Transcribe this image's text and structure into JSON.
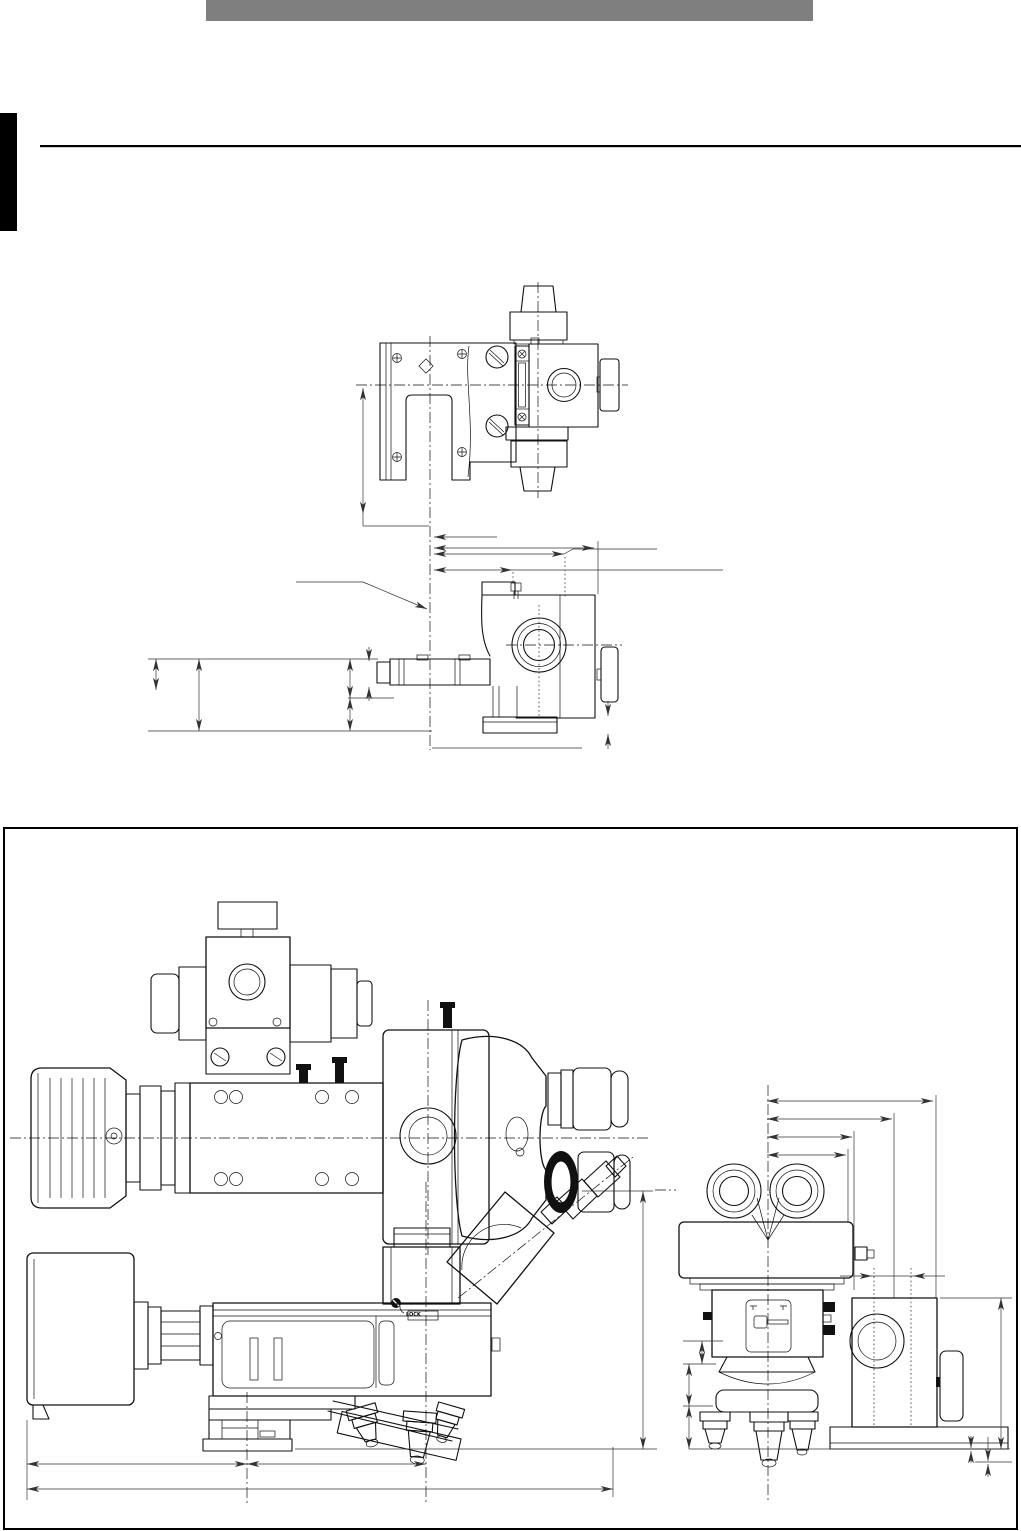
{
  "page": {
    "background": "#ffffff"
  },
  "header_bar": {
    "color": "#7f7f7f"
  },
  "side_tab": {
    "color": "#000000"
  },
  "divider_rule": {
    "color": "#000000"
  },
  "figure_box": {
    "border_color": "#000000"
  },
  "drawing": {
    "line_color": "#111111",
    "labels": {
      "lock": "LOCK"
    }
  }
}
